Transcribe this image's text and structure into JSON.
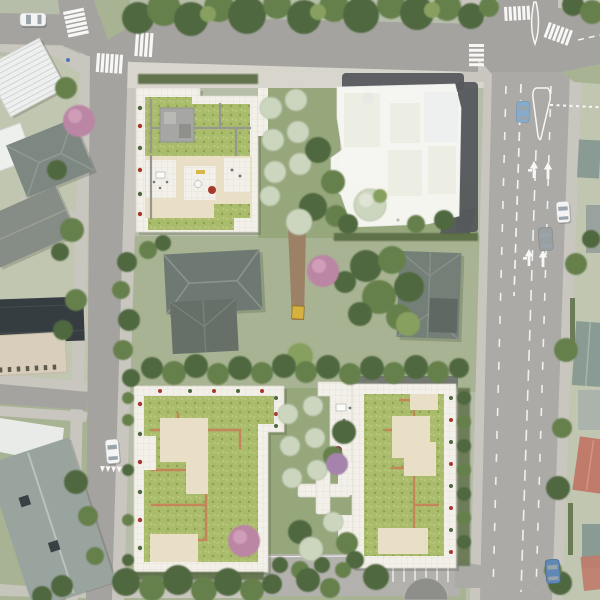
{
  "meta": {
    "type": "aerial-site-plan-rendering",
    "description": "Aerial masterplan rendering of a residential development: two new green-roof building blocks (north block with a ghosted white building, south block with two green-roof slabs) around existing houses and gardens; tree-lined road to the north, narrow street to the west, multi-lane avenue with turn arrows to the east, parking strip at the south",
    "width": 600,
    "height": 600
  },
  "palette": {
    "ground": "#b6bda9",
    "lawn_pale": "#c1c6b1",
    "lawn": "#a7b392",
    "garden_lawn": "#96a77c",
    "road": "#a5a3a0",
    "road_avenue": "#abaaa6",
    "sidewalk": "#c9c6c0",
    "plaza": "#d8d5cc",
    "parking": "#b3b1ad",
    "marking": "#f7f7f5",
    "tree_dark": "#4f683f",
    "tree_mid": "#66804c",
    "tree_light": "#87a05e",
    "tree_pale": "#ccd5bd",
    "tree_pink": "#bb85a4",
    "tree_lilac": "#a583ad",
    "hedge": "#55683f",
    "terrace_white": "#f2f0e9",
    "terrace_line": "#dfdbd0",
    "patio_cream": "#e9dfc7",
    "green_roof": "#a9bc6b",
    "green_roof2": "#b7c47a",
    "roof_path_orange": "#c5855a",
    "roof_path_gray": "#98978f",
    "roof_structure": "#a6a6a4",
    "ghost_building": "#f6f6f2",
    "ghost_roof_patch": "#e0e5d0",
    "ghost_blue": "#e4e9ec",
    "ghost_dark": "#56585c",
    "house_roof_dark": "#6e7973",
    "house_roof_mid": "#7e8882",
    "house_white": "#e9ebe9",
    "house_tan": "#d8cebb",
    "house_dark_flat": "#363d40",
    "roof_teal": "#8a9b93",
    "roof_salmon": "#c07b6b",
    "apartment_roof": "#9aa49f",
    "dirt_path": "#9c8166",
    "machine_yellow": "#d6b13f",
    "flower_red": "#a4392c",
    "bench_yellow": "#d4b84a"
  },
  "scene": {
    "blocks": [
      {
        "id": "north-block",
        "features": [
          "green-roof-building",
          "white-terraces",
          "rooftop-structure",
          "orchard-garden",
          "ghosted-white-building"
        ]
      },
      {
        "id": "south-block",
        "features": [
          "two-green-roof-slabs",
          "orange-roof-paths",
          "cream-patios",
          "white-terrace",
          "orchard-rows",
          "cross-path",
          "pink-trees"
        ]
      }
    ],
    "roads": [
      {
        "id": "top-road",
        "orientation": "horizontal"
      },
      {
        "id": "west-street",
        "orientation": "vertical"
      },
      {
        "id": "east-avenue",
        "orientation": "vertical",
        "markings": [
          "lane-dashes",
          "turn-arrows",
          "traffic-islands",
          "dotted-line"
        ]
      },
      {
        "id": "west-side-street",
        "orientation": "horizontal"
      },
      {
        "id": "south-parking",
        "markings": [
          "parking-stalls"
        ]
      }
    ],
    "crosswalk_count": 6,
    "turn_arrow_count": 4,
    "yield_teeth_count": 5,
    "cars": [
      {
        "color": "white",
        "road": "top-road"
      },
      {
        "color": "light-blue",
        "road": "east-avenue"
      },
      {
        "color": "white",
        "road": "east-avenue"
      },
      {
        "color": "gray",
        "road": "east-avenue"
      },
      {
        "color": "white",
        "road": "west-street"
      },
      {
        "color": "blue",
        "road": "east-avenue-south"
      }
    ],
    "existing_buildings": [
      "white-ribbed-industrial-roof",
      "gray-hip-house",
      "gray-long-house",
      "dark-flat-roof-block",
      "tan-apartment-block",
      "teal-apartment-building",
      "two-center-houses",
      "east-row-houses"
    ]
  }
}
